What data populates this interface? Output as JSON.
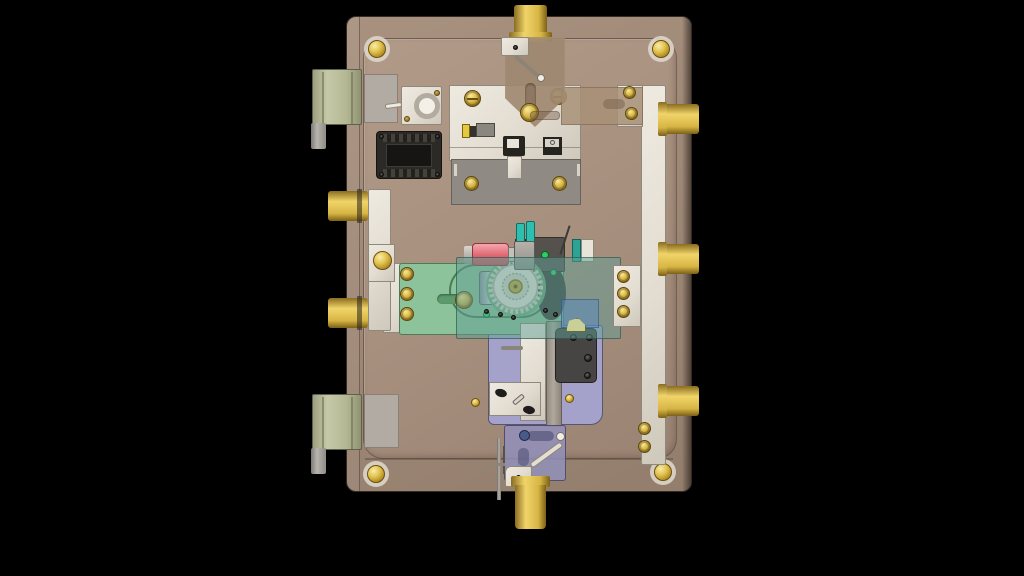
{
  "scene": {
    "description": "3D CAD render: back side of a safe-door lock mechanism viewed face-on, centered on a black background",
    "background": "#000000",
    "visible_text": []
  },
  "colors": {
    "bg": "#000000",
    "door_face": "#a8917f",
    "door_face_dark": "#937d6c",
    "inner_panel": "#a78f7e",
    "ivory": "#e2dcd1",
    "ivory_border": "#8f897d",
    "gray_plate": "#8f8b84",
    "gray_plate_lt": "#b2aba3",
    "brass": "#d7b545",
    "brass_hi": "#f0d469",
    "brass_dark": "#8a6c20",
    "hinge_green": "#b4b794",
    "cylinder_gray": "#a09c98",
    "pcb_green": "#8cc39a",
    "pcb_green_dark": "#4e7a58",
    "teal_glass": "rgba(96,158,148,0.5)",
    "blue_glass": "rgba(85,135,200,0.45)",
    "motor_red": "#df6671",
    "motor_red_hi": "#f4a7ae",
    "silver": "#c4c1bb",
    "gear_face": "#eee9de",
    "gear_ring": "#d8d2c4",
    "lavender": "#a4a2ca",
    "lavender_dark": "#57566f",
    "purple_glass": "rgba(146,144,186,0.85)",
    "dark_block": "#474543",
    "black_part": "#26241f",
    "led_green": "#2ecf62",
    "cap_teal": "#2fbfae",
    "wedge_olive": "#c9cf96",
    "tan_glass": "rgba(168,144,120,0.85)"
  },
  "parts": [
    "door-back-plate",
    "inner-cover-plate",
    "corner-dome-screws",
    "top-locking-bolt",
    "bottom-locking-bolt",
    "left-locking-bolts",
    "right-locking-bolts",
    "left-bolt-rail",
    "right-bolt-rail",
    "hinge-blocks",
    "rotary-solenoid",
    "connector-module",
    "relock-plate-white",
    "relock-plate-gray",
    "micro-switch",
    "relay",
    "pivot-bracket",
    "link-rod",
    "drive-motor",
    "gear-train",
    "bolt-cam-plate",
    "acrylic-cover",
    "lavender-mount-plate",
    "switch-block",
    "slide-bracket",
    "return-spring-rod"
  ]
}
